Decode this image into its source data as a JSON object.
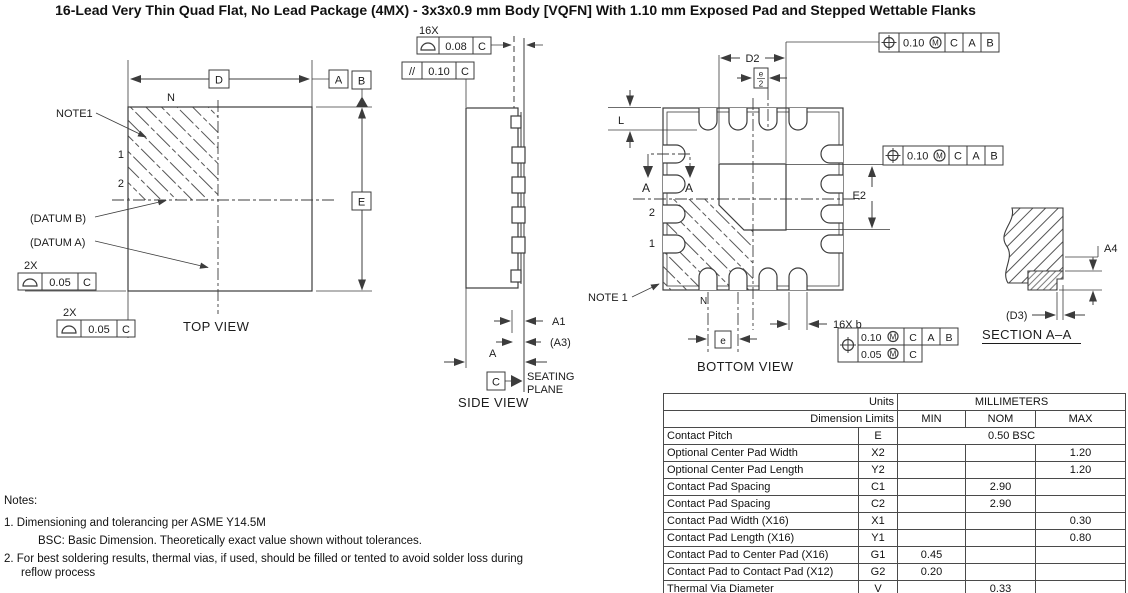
{
  "title": "16-Lead Very Thin Quad Flat, No Lead Package (4MX) - 3x3x0.9 mm Body [VQFN] With 1.10 mm Exposed Pad and Stepped Wettable Flanks",
  "top_view": {
    "caption": "TOP VIEW",
    "note1_label": "NOTE1",
    "n_label": "N",
    "pin1": "1",
    "pin2": "2",
    "datum_b_ref": "(DATUM B)",
    "datum_a_ref": "(DATUM A)",
    "dim_d": "D",
    "dim_e": "E",
    "datum_a": "A",
    "datum_b": "B",
    "flatness_top": {
      "qty": "2X",
      "tol": "0.05",
      "datum": "C"
    },
    "flatness_left": {
      "qty": "2X",
      "tol": "0.05",
      "datum": "C"
    }
  },
  "side_view": {
    "caption": "SIDE VIEW",
    "profile_tol": {
      "qty": "16X",
      "tol": "0.08",
      "datum": "C"
    },
    "parallel_tol": {
      "sym": "//",
      "tol": "0.10",
      "datum": "C"
    },
    "dim_a1": "A1",
    "dim_a3": "(A3)",
    "dim_a": "A",
    "datum_c": "C",
    "seating_line1": "SEATING",
    "seating_line2": "PLANE"
  },
  "bottom_view": {
    "caption": "BOTTOM VIEW",
    "dim_d2": "D2",
    "dim_e2": "E2",
    "dim_l": "L",
    "pitch_half_num": "e",
    "pitch_half_den": "2",
    "pitch_label": "e",
    "pad_width_label": "16X b",
    "note1_label": "NOTE 1",
    "n_label": "N",
    "pin1": "1",
    "pin2": "2",
    "section_label_left": "A",
    "section_label_right": "A",
    "fcf_top": {
      "tol": "0.10",
      "mod": "M",
      "d1": "C",
      "d2": "A",
      "d3": "B"
    },
    "fcf_right": {
      "tol": "0.10",
      "mod": "M",
      "d1": "C",
      "d2": "A",
      "d3": "B"
    },
    "fcf_pads": {
      "tol1": "0.10",
      "mod1": "M",
      "d11": "C",
      "d12": "A",
      "d13": "B",
      "tol2": "0.05",
      "mod2": "M",
      "d21": "C"
    }
  },
  "section_view": {
    "caption": "SECTION A–A",
    "dim_a4": "A4",
    "dim_d3": "(D3)"
  },
  "table": {
    "units_label": "Units",
    "millimeters_label": "MILLIMETERS",
    "dimension_limits_label": "Dimension Limits",
    "min_label": "MIN",
    "nom_label": "NOM",
    "max_label": "MAX",
    "rows": [
      {
        "name": "Contact Pitch",
        "symbol": "E",
        "span": "0.50 BSC"
      },
      {
        "name": "Optional Center Pad Width",
        "symbol": "X2",
        "min": "",
        "nom": "",
        "max": "1.20"
      },
      {
        "name": "Optional Center Pad Length",
        "symbol": "Y2",
        "min": "",
        "nom": "",
        "max": "1.20"
      },
      {
        "name": "Contact Pad Spacing",
        "symbol": "C1",
        "min": "",
        "nom": "2.90",
        "max": ""
      },
      {
        "name": "Contact Pad Spacing",
        "symbol": "C2",
        "min": "",
        "nom": "2.90",
        "max": ""
      },
      {
        "name": "Contact Pad Width (X16)",
        "symbol": "X1",
        "min": "",
        "nom": "",
        "max": "0.30"
      },
      {
        "name": "Contact Pad Length (X16)",
        "symbol": "Y1",
        "min": "",
        "nom": "",
        "max": "0.80"
      },
      {
        "name": "Contact Pad to Center Pad (X16)",
        "symbol": "G1",
        "min": "0.45",
        "nom": "",
        "max": ""
      },
      {
        "name": "Contact Pad to Contact Pad (X12)",
        "symbol": "G2",
        "min": "0.20",
        "nom": "",
        "max": ""
      },
      {
        "name": "Thermal Via Diameter",
        "symbol": "V",
        "min": "",
        "nom": "0.33",
        "max": ""
      }
    ]
  },
  "notes": {
    "heading": "Notes:",
    "item1": "1.  Dimensioning and tolerancing per ASME Y14.5M",
    "item1_sub": "BSC: Basic Dimension. Theoretically exact value shown without tolerances.",
    "item2": "2.  For best soldering results, thermal vias, if used, should be filled or tented to avoid solder loss during",
    "item2_cont": "reflow process"
  }
}
